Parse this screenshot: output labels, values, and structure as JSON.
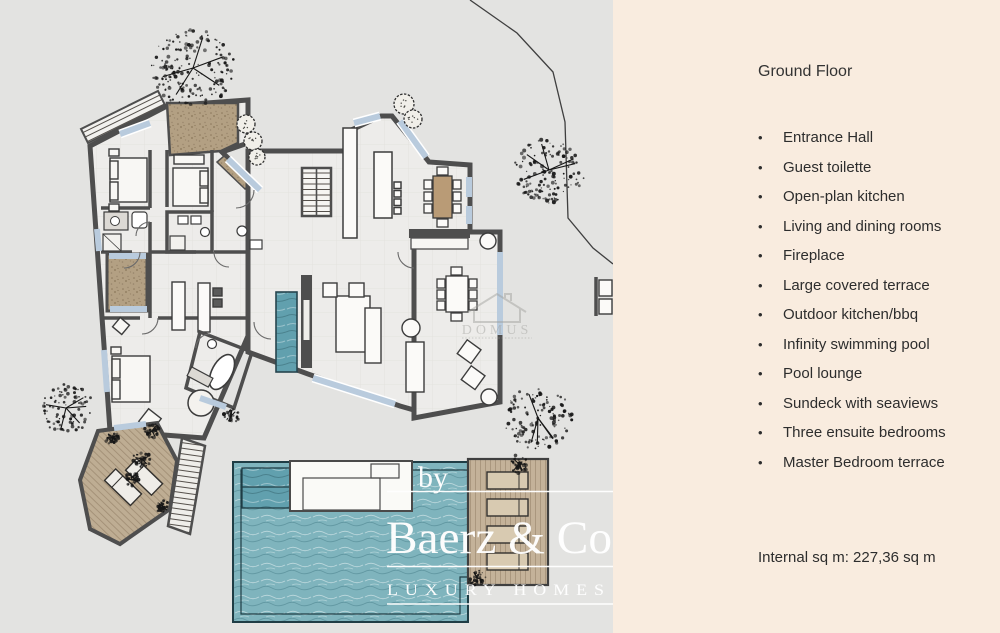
{
  "panel": {
    "title": "Ground Floor",
    "bullet": "•",
    "items": [
      "Entrance Hall",
      "Guest toilette",
      "Open-plan kitchen",
      "Living and dining rooms",
      "Fireplace",
      "Large covered terrace",
      "Outdoor kitchen/bbq",
      "Infinity swimming pool",
      "Pool lounge",
      "Sundeck with seaviews",
      "Three ensuite bedrooms",
      "Master Bedroom terrace"
    ],
    "footer": "Internal sq m: 227,36 sq m",
    "bg_color": "#f9ecdf",
    "text_color": "#2d2d2d"
  },
  "watermark": {
    "prefix": "by",
    "brand": "Baerz & Co",
    "tagline": "LUXURY HOMES",
    "color": "#ffffff"
  },
  "plan_watermark": {
    "brand": "DOMUS"
  },
  "colors": {
    "canvas": "#e3e3e1",
    "wall": "#4e4e4e",
    "floor": "#edecea",
    "window": "#b9cbdd",
    "deck_wood": "#c4b299",
    "gravel": "#b3a083",
    "pool": "#7fb4bd",
    "pool_dark": "#61a0ae"
  }
}
